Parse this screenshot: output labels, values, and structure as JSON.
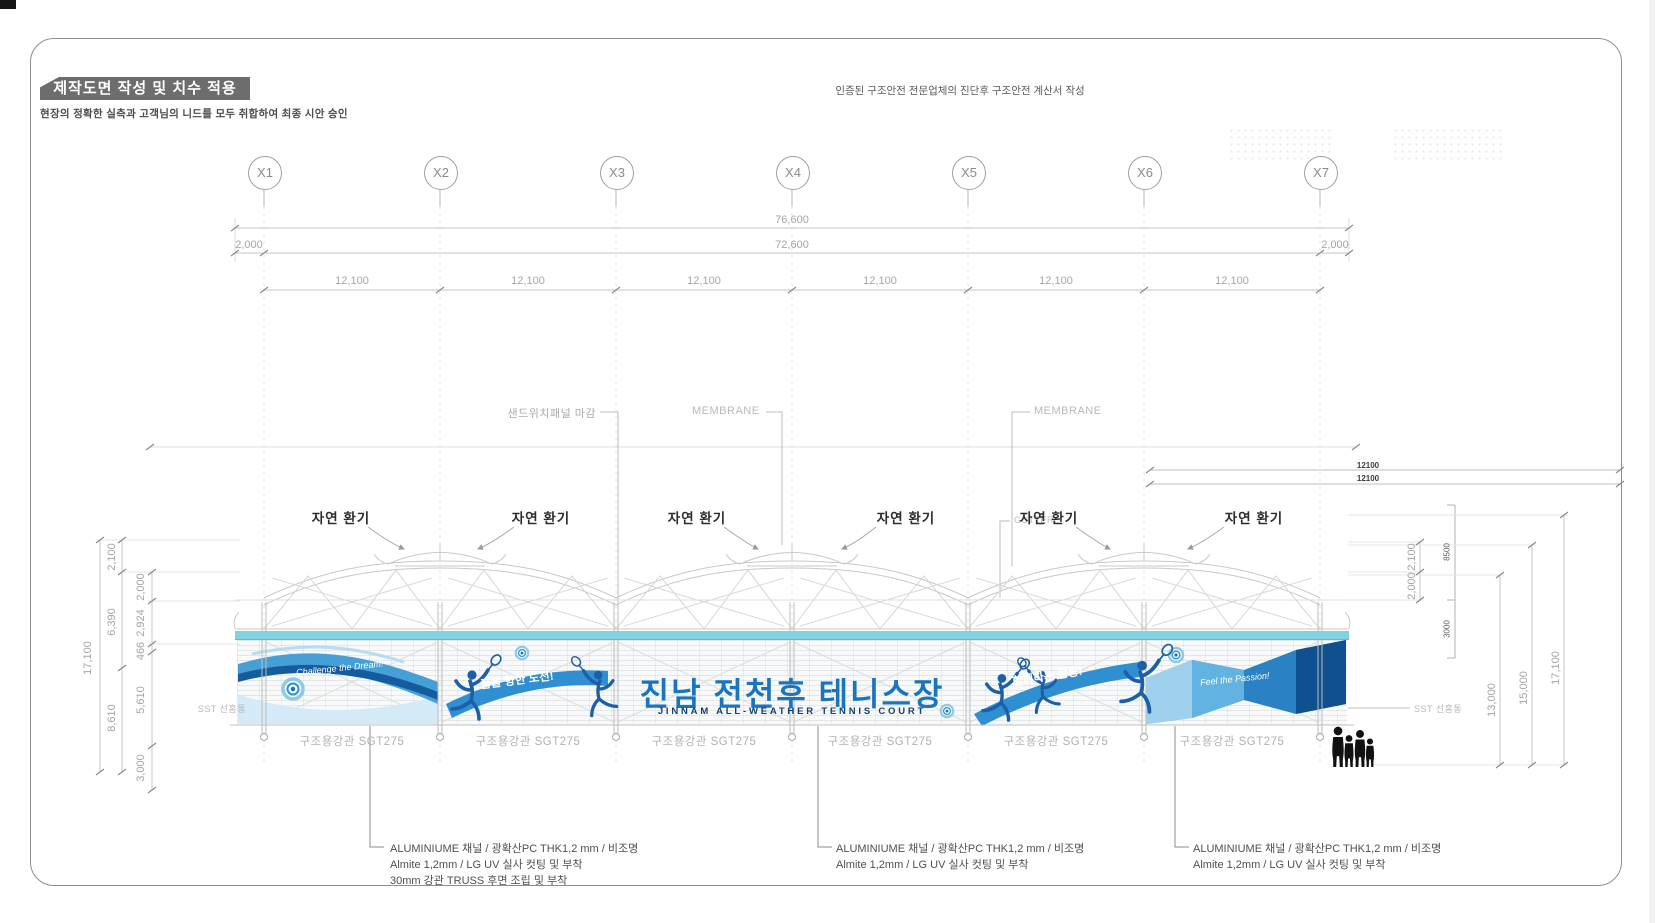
{
  "header": {
    "title": "제작도면 작성 및 치수 적용",
    "subtitle": "현장의 정확한 실측과 고객님의 니드를 모두 취합하여 최종 시안 승인",
    "top_note": "인증된 구조안전 전문업체의 진단후 구조안전 계산서 작성"
  },
  "grid": {
    "labels": [
      "X1",
      "X2",
      "X3",
      "X4",
      "X5",
      "X6",
      "X7"
    ]
  },
  "dimensions": {
    "top": {
      "overall": "76,600",
      "left_offset": "2,000",
      "inner": "72,600",
      "right_offset": "2,000",
      "bays": [
        "12,100",
        "12,100",
        "12,100",
        "12,100",
        "12,100",
        "12,100"
      ]
    },
    "left": {
      "overall": "17,100",
      "outer": [
        "2,100",
        "6,390",
        "8,610"
      ],
      "inner": [
        "2,000",
        "2,924",
        "466",
        "5,610",
        "3,000"
      ]
    },
    "right": {
      "top": [
        "2,100",
        "2,000"
      ],
      "roof": [
        "8500",
        "3000"
      ],
      "heights": [
        "13,000",
        "15,000",
        "17,100"
      ],
      "modules": [
        "12100",
        "12100"
      ]
    }
  },
  "callouts": {
    "panel": "샌드위치패널 마감",
    "membrane_left": "MEMBRANE",
    "membrane_right": "MEMBRANE",
    "gutter": "GUTTER",
    "sst_left": "SST 선홈통",
    "sst_right": "SST 선홈통",
    "vents": [
      "자연 환기",
      "자연 환기",
      "자연 환기",
      "자연 환기",
      "자연 환기",
      "자연 환기"
    ]
  },
  "building": {
    "sign": {
      "title": "진남 전천후 테니스장",
      "subtitle": "JINNAM ALL-WEATHER TENNIS COURT"
    },
    "slogans": {
      "left_wave": "Challenge the Dream!",
      "left_ribbon": "꿈을 향한 도전!",
      "right_ribbon": "함께하는 감동!",
      "right_wave": "Feel the Passion!"
    },
    "column_labels": [
      "구조용강관 SGT275",
      "구조용강관 SGT275",
      "구조용강관 SGT275",
      "구조용강관 SGT275",
      "구조용강관 SGT275",
      "구조용강관 SGT275"
    ]
  },
  "annotations": {
    "left": [
      "ALUMINIUME 채널 / 광확산PC THK1,2 mm / 비조명",
      "Almite 1,2mm / LG UV 실사 컷팅 및 부착",
      "30mm 강관 TRUSS 후면 조립 및 부착"
    ],
    "middle": [
      "ALUMINIUME 채널 / 광확산PC THK1,2 mm / 비조명",
      "Almite 1,2mm / LG UV 실사 컷팅 및 부착"
    ],
    "right": [
      "ALUMINIUME 채널 / 광확산PC THK1,2 mm / 비조명",
      "Almite 1,2mm / LG UV 실사 컷팅 및 부착"
    ]
  },
  "colors": {
    "accent_blue": "#1b75bc",
    "navy": "#17406e",
    "teal_band": "#82d1de",
    "silhouette_blue": "#1a5fa8",
    "dim_text": "#a5a5a5",
    "title_bar": "#6d6d6d"
  }
}
